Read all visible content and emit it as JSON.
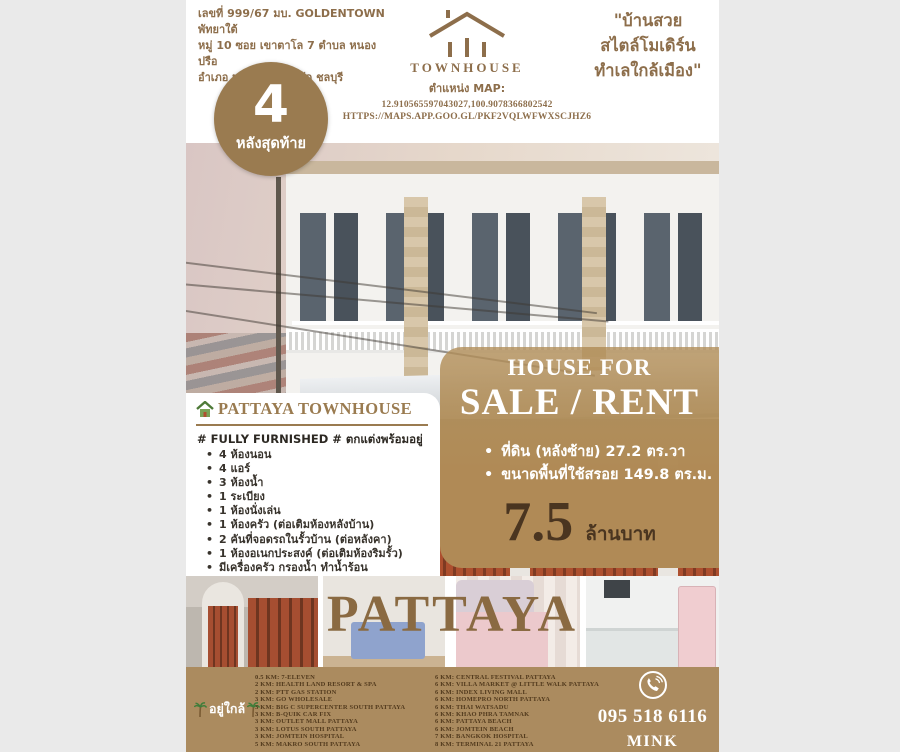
{
  "colors": {
    "accent_brown": "#8d6e4b",
    "badge_brown": "#9a7b50",
    "banner_tan": "#b08a56",
    "footer_tan": "#ab8b5f",
    "price_dark_brown": "#4a3520",
    "watermark_brown": "#8a6a42",
    "page_margin_gray": "#eaeaea"
  },
  "header": {
    "address_lines": [
      "เลขที่ 999/67 มบ. GOLDENTOWN พัทยาใต้",
      "หมู่ 10 ซอย เขาตาโล 7 ตำบล หนองปรือ",
      "อำเภอ บางละมุง จังหวัด ชลบุรี"
    ],
    "logo": {
      "brand": "TOWNHOUSE",
      "map_label": "ตำแหน่ง MAP:",
      "coordinates": "12.910565597043027,100.9078366802542",
      "map_url": "HTTPS://MAPS.APP.GOO.GL/PKF2VQLWFWXSCJHZ6"
    },
    "tagline_lines": [
      "\"บ้านสวย",
      "สไตล์โมเดิร์น",
      "ทำเลใกล้เมือง\""
    ]
  },
  "badge": {
    "number": "4",
    "label": "หลังสุดท้าย"
  },
  "listing": {
    "title": "PATTAYA TOWNHOUSE",
    "furnished_line": "# FULLY FURNISHED # ตกแต่งพร้อมอยู่",
    "features": [
      "4 ห้องนอน",
      "4 แอร์",
      "3 ห้องน้ำ",
      "1 ระเบียง",
      "1 ห้องนั่งเล่น",
      "1 ห้องครัว (ต่อเติมห้องหลังบ้าน)",
      "2 คันที่จอดรถในรั้วบ้าน (ต่อหลังคา)",
      "1 ห้องอเนกประสงค์ (ต่อเติมห้องริมรั้ว)",
      "มีเครื่องครัว กรองน้ำ ทำน้ำร้อน"
    ]
  },
  "sale": {
    "heading_top": "HOUSE FOR",
    "heading_main": "SALE / RENT",
    "details": [
      "ที่ดิน (หลังซ้าย) 27.2 ตร.วา",
      "ขนาดพื้นที่ใช้สรอย 149.8 ตร.ม."
    ],
    "price": "7.5",
    "price_unit": "ล้านบาท"
  },
  "gallery": {
    "watermark": "PATTAYA",
    "photos": [
      "front-gate",
      "bedroom-blue",
      "bedroom-pink",
      "kitchen"
    ]
  },
  "footer": {
    "nearby_label": "อยู่ใกล้",
    "distances_col1": [
      "0.5 KM: 7-ELEVEN",
      "2 KM: HEALTH LAND RESORT & SPA",
      "2 KM: PTT GAS STATION",
      "3 KM: GO WHOLESALE",
      "3 KM: BIG C SUPERCENTER SOUTH PATTAYA",
      "3 KM: B-QUIK CAR FIX",
      "3 KM: OUTLET MALL PATTAYA",
      "3 KM: LOTUS SOUTH PATTAYA",
      "3 KM: JOMTEIN HOSPITAL",
      "5 KM: MAKRO SOUTH PATTAYA"
    ],
    "distances_col2": [
      "6 KM: CENTRAL FESTIVAL PATTAYA",
      "6 KM: VILLA MARKET @ LITTLE WALK PATTAYA",
      "6 KM: INDEX LIVING MALL",
      "6 KM: HOMEPRO NORTH PATTAYA",
      "6 KM: THAI WATSADU",
      "6 KM: KHAO PHRA TAMNAK",
      "6 KM: PATTAYA BEACH",
      "6 KM: JOMTEIN BEACH",
      "7 KM: BANGKOK HOSPITAL",
      "8 KM: TERMINAL 21 PATTAYA"
    ],
    "phone": "095 518 6116",
    "contact_name": "MINK"
  }
}
